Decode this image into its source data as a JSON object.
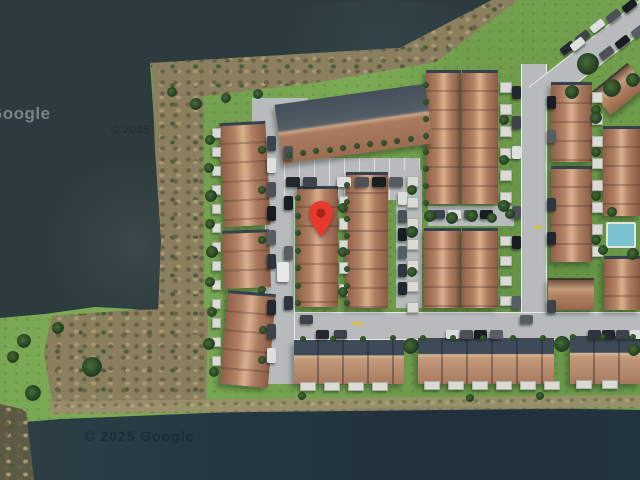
{
  "app": {
    "name": "satellite-map-view",
    "view_type": "satellite"
  },
  "map": {
    "marker": {
      "label": "selected-location",
      "color": "#E8392C",
      "inner_color": "#A3281B"
    },
    "attributions": {
      "logo": "Google",
      "copyright_top": "© 2025",
      "copyright_bottom": "© 2025 Google"
    },
    "palette": {
      "water": "#2C3B3E",
      "water_deep": "#223440",
      "grass": "#74A14F",
      "scrub": "#8A7F5F",
      "road": "#B7BBBC",
      "roof": "#B28266",
      "roof_dark_slope": "#3D4B58",
      "building_flat": "#525C64",
      "shed": "#DADBD5",
      "pool": "#78C2CF",
      "tree": "#2C4A26"
    }
  }
}
